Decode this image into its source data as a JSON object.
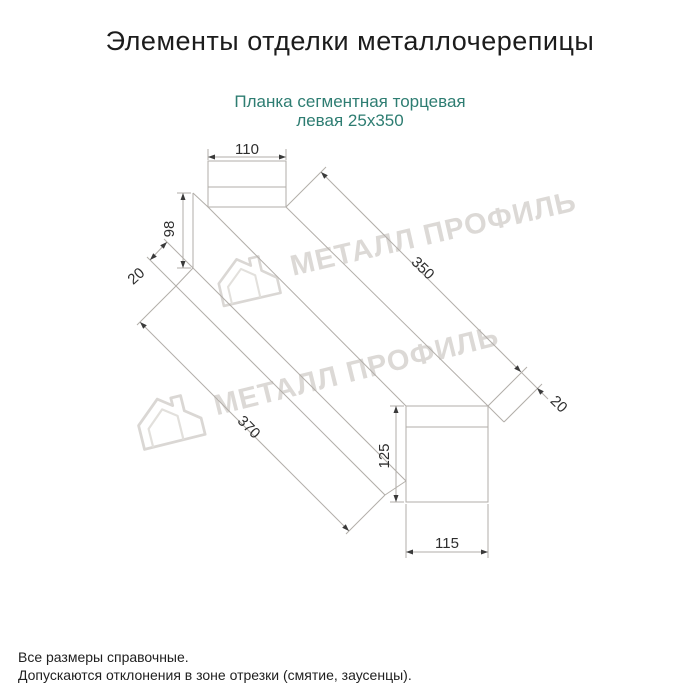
{
  "page": {
    "title": "Элементы отделки металлочерепицы",
    "subtitle_line1": "Планка сегментная торцевая",
    "subtitle_line2": "левая 25х350",
    "watermark_text": "МЕТАЛЛ ПРОФИЛЬ",
    "notes": [
      "Все размеры справочные.",
      "Допускаются отклонения в зоне отрезки (смятие, заусенцы)."
    ],
    "colors": {
      "title": "#1c1c1c",
      "subtitle": "#2e7d72",
      "drawing_line": "#b2aea9",
      "dimension_text": "#2e2e2e",
      "arrowhead": "#3a3a3a",
      "watermark": "#d6d3cf",
      "background": "#ffffff"
    }
  },
  "drawing": {
    "product": "Планка сегментная торцевая левая 25х350",
    "dimensions": {
      "top_width": "110",
      "left_height": "98",
      "left_fold": "20",
      "length_top": "350",
      "right_fold": "20",
      "length_bottom": "370",
      "right_height": "125",
      "bottom_width": "115"
    }
  }
}
